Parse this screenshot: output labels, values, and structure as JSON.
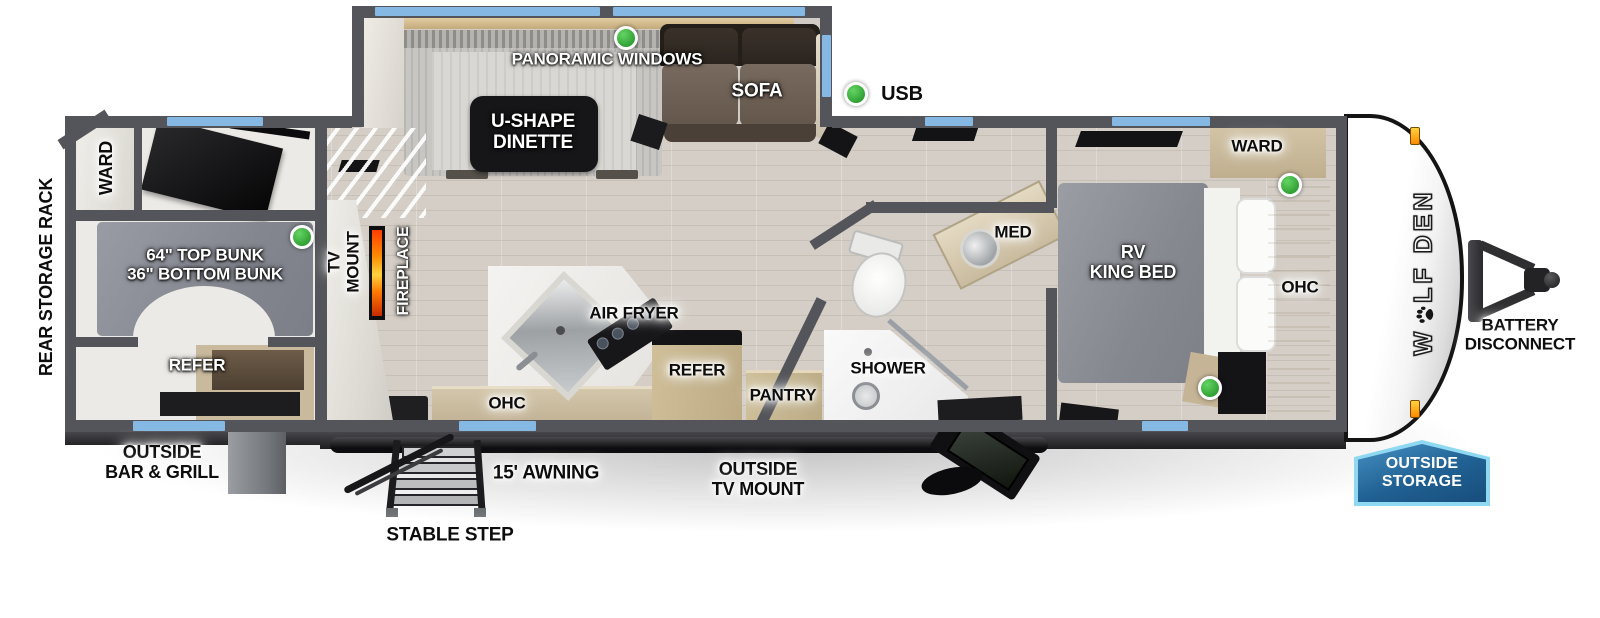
{
  "labels": {
    "panoramic_windows": "PANORAMIC WINDOWS",
    "u_shape_dinette": "U-SHAPE\nDINETTE",
    "sofa": "SOFA",
    "usb": "USB",
    "ward_bunk": "WARD",
    "rear_storage_rack": "REAR STORAGE RACK",
    "bunks": "64\" TOP BUNK\n36\" BOTTOM BUNK",
    "refer_bunk": "REFER",
    "tv_mount": "TV\nMOUNT",
    "fireplace": "FIREPLACE",
    "air_fryer": "AIR FRYER",
    "ohc_kitchen": "OHC",
    "refer_kitchen": "REFER",
    "pantry": "PANTRY",
    "shower": "SHOWER",
    "med": "MED",
    "rv_king_bed": "RV\nKING BED",
    "ward_bedroom": "WARD",
    "ohc_bedroom": "OHC",
    "outside_bar_grill": "OUTSIDE\nBAR & GRILL",
    "stable_step": "STABLE STEP",
    "awning": "15' AWNING",
    "outside_tv_mount": "OUTSIDE\nTV MOUNT",
    "battery_disconnect": "BATTERY\nDISCONNECT",
    "outside_storage": "OUTSIDE\nSTORAGE"
  },
  "brand": {
    "part1": "W",
    "part2": "LF DEN",
    "full": "WOLF DEN"
  },
  "colors": {
    "wall": "#54555a",
    "floor_wood": "#d4cec6",
    "window_blue": "#85b9e3",
    "usb_green": "#3aae3c",
    "badge_blue": "#206092",
    "badge_border": "#8fd8f2",
    "fireplace_orange": "#ff8a00",
    "cabinet_tan": "#c9ba9e",
    "bunk_gray": "#8e909a",
    "sofa_brown": "#6b5e53",
    "clearance_light_orange": "#ffab1e"
  },
  "indicators": {
    "usb_dot_count": 5
  }
}
